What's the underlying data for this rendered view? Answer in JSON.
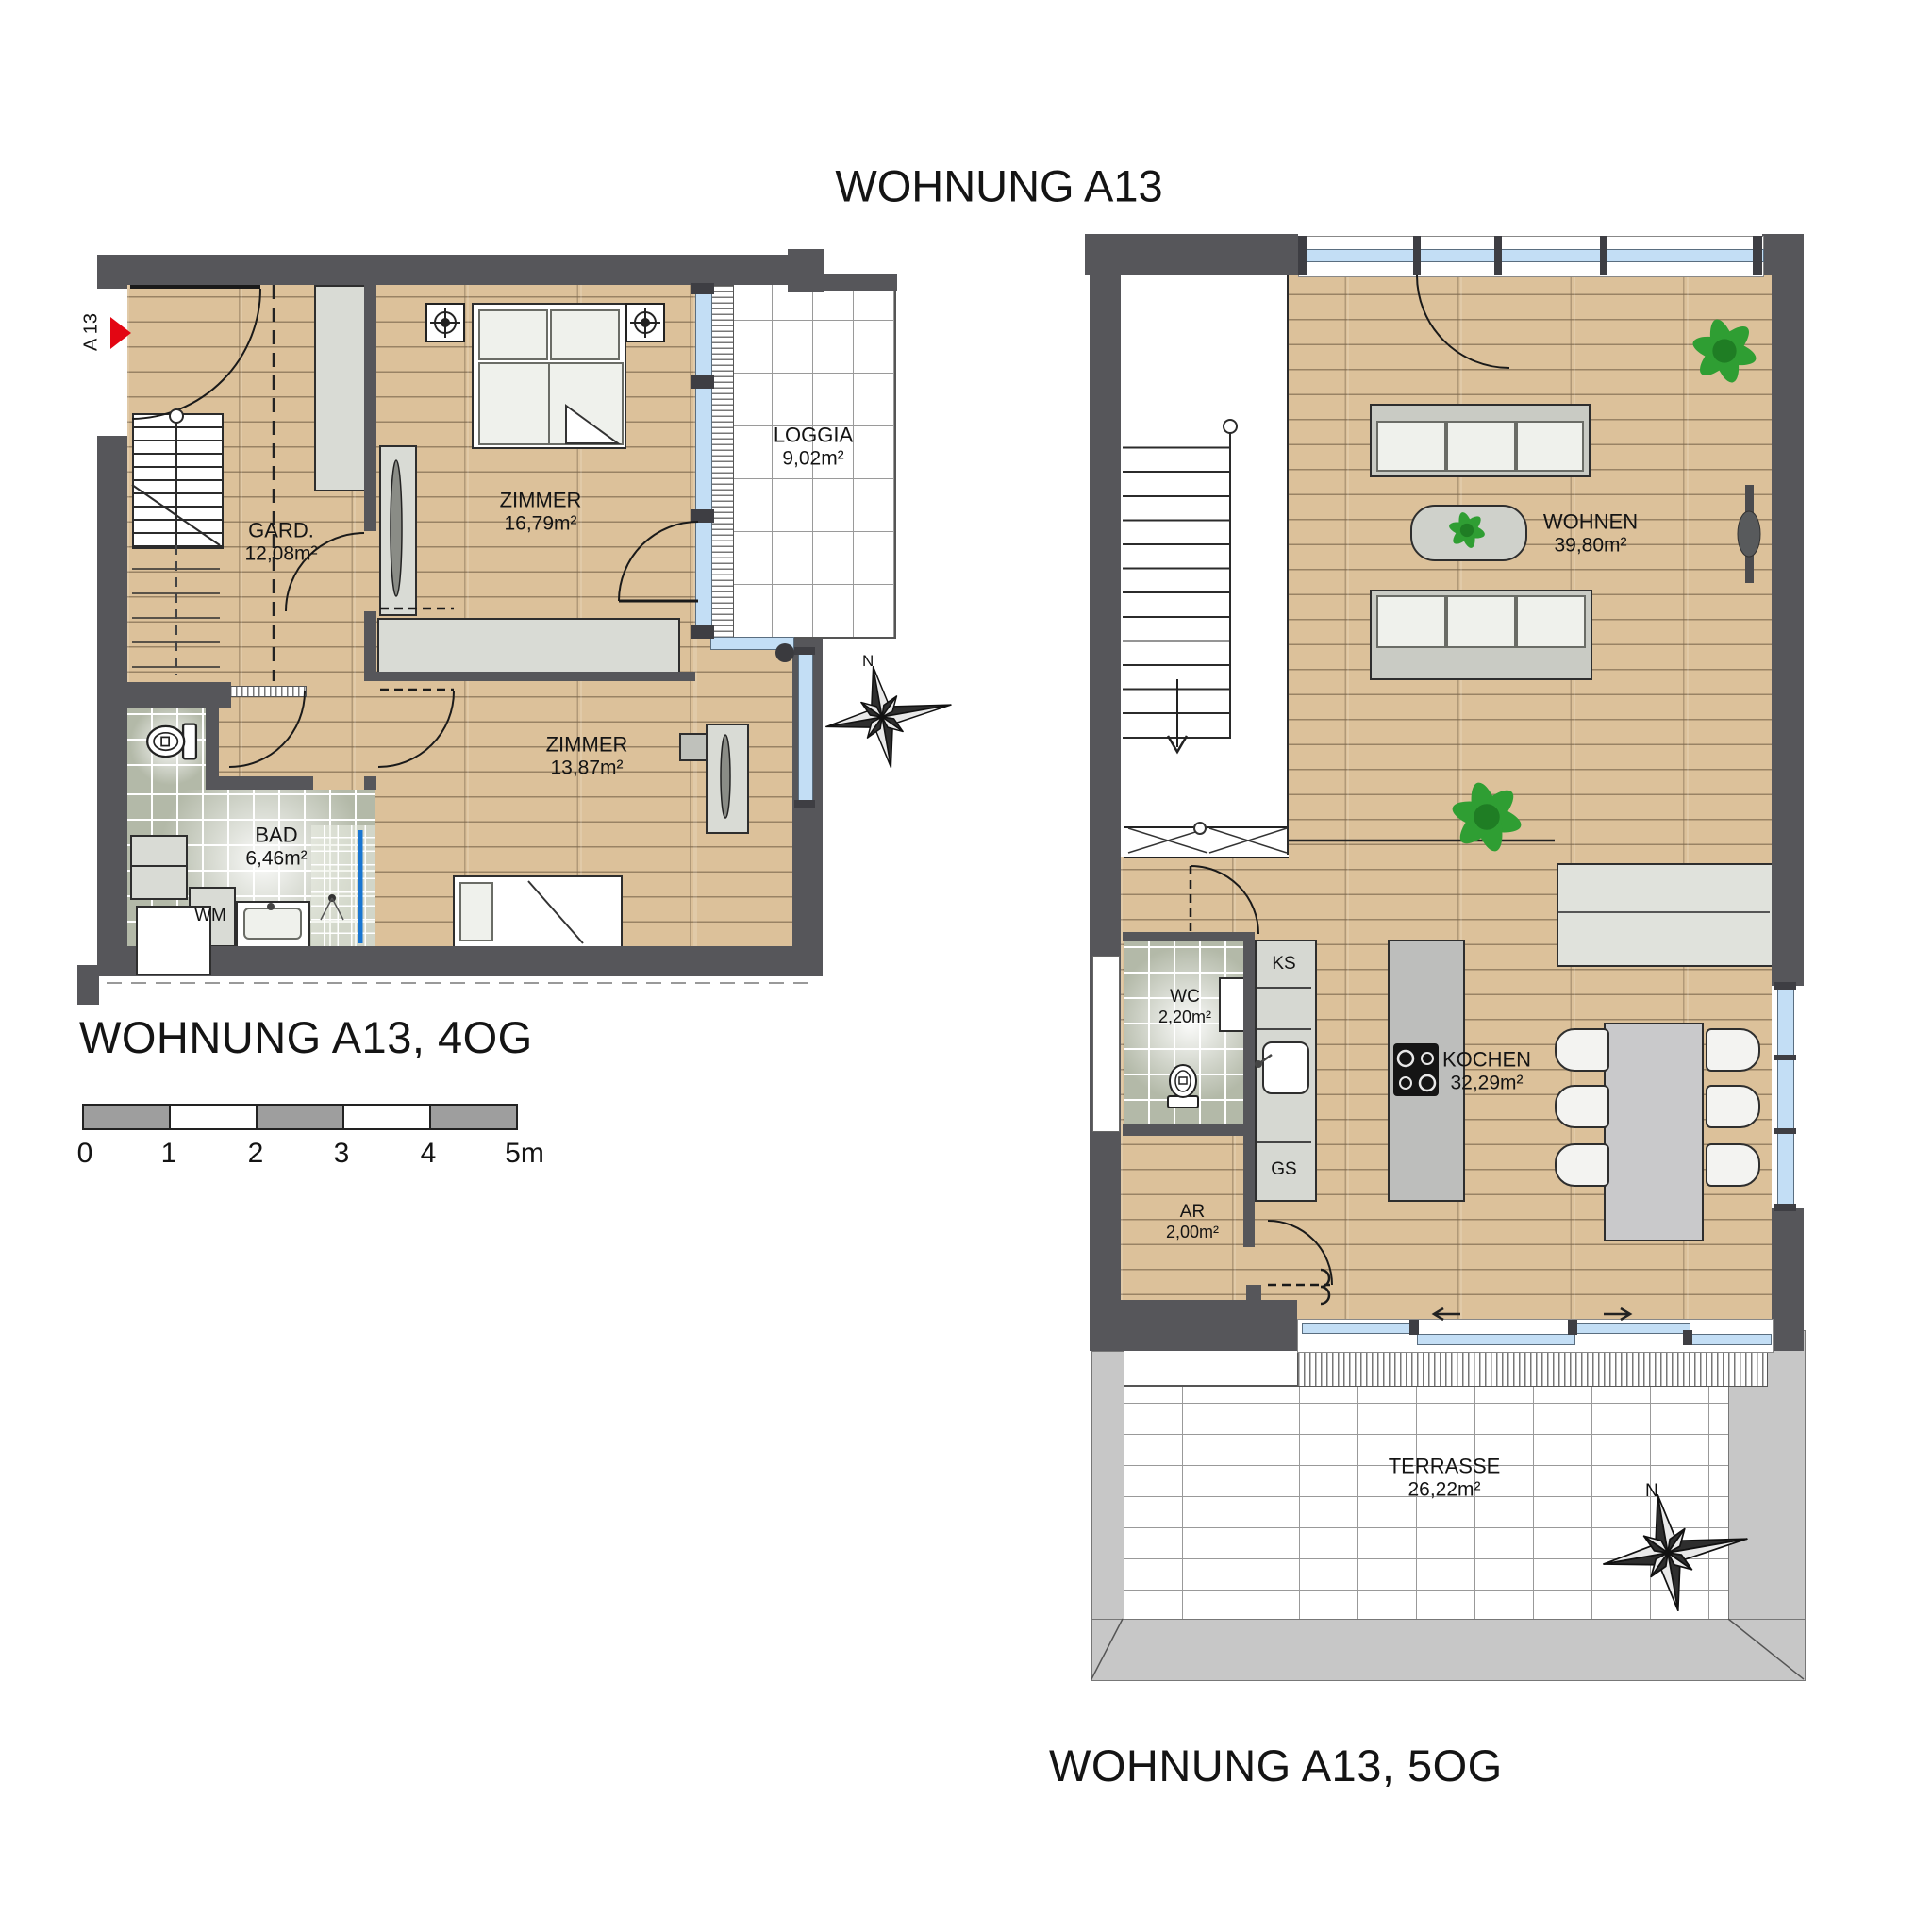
{
  "title": "WOHNUNG A13",
  "compass_label": "N",
  "plan_4og": {
    "caption": "WOHNUNG A13, 4OG",
    "entry_marker": "A 13",
    "rooms": {
      "gard": {
        "name": "GARD.",
        "area": "12,08m²"
      },
      "zimmer1": {
        "name": "ZIMMER",
        "area": "16,79m²"
      },
      "loggia": {
        "name": "LOGGIA",
        "area": "9,02m²"
      },
      "zimmer2": {
        "name": "ZIMMER",
        "area": "13,87m²"
      },
      "bad": {
        "name": "BAD",
        "area": "6,46m²"
      }
    },
    "appliances": {
      "wm": "WM"
    }
  },
  "plan_5og": {
    "caption": "WOHNUNG A13, 5OG",
    "rooms": {
      "wohnen": {
        "name": "WOHNEN",
        "area": "39,80m²"
      },
      "wc": {
        "name": "WC",
        "area": "2,20m²"
      },
      "kochen": {
        "name": "KOCHEN",
        "area": "32,29m²"
      },
      "ar": {
        "name": "AR",
        "area": "2,00m²"
      },
      "terrasse": {
        "name": "TERRASSE",
        "area": "26,22m²"
      }
    },
    "appliances": {
      "ks": "KS",
      "gs": "GS"
    }
  },
  "scale_bar": {
    "ticks": [
      "0",
      "1",
      "2",
      "3",
      "4",
      "5m"
    ]
  },
  "colors": {
    "wall": "#56565a",
    "wood": "#dcc19a",
    "tile": "#b3b9a8",
    "window_blue": "#c3def5",
    "plant_green": "#2f9e33",
    "accent_red": "#e30613"
  }
}
